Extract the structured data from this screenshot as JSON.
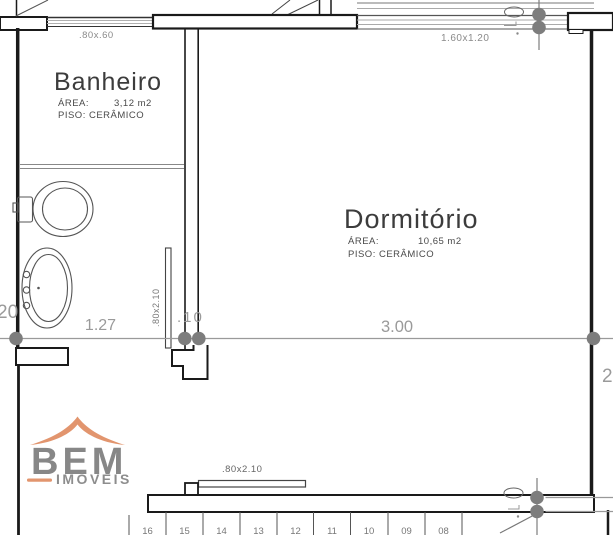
{
  "drawing": {
    "rooms": {
      "banheiro": {
        "name": "Banheiro",
        "area_label": "ÁREA:",
        "area_value": "3,12 m2",
        "floor_line": "PISO: CERÂMICO"
      },
      "dormitorio": {
        "name": "Dormitório",
        "area_label": "ÁREA:",
        "area_value": "10,65 m2",
        "floor_line": "PISO: CERÂMICO"
      }
    },
    "windows": {
      "banheiro_window": ".80x.60",
      "dormitorio_window": "1.60x1.20"
    },
    "doors": {
      "banheiro_door": ".80x2.10",
      "hall_door": ".80x2.10"
    },
    "dimensions": {
      "left_partial": "20",
      "banheiro_width": "1.27",
      "wall_thickness": ".10",
      "dormitorio_width": "3.00",
      "right_partial": "2"
    },
    "stairs": {
      "steps": [
        "16",
        "15",
        "14",
        "13",
        "12",
        "11",
        "10",
        "09",
        "08"
      ]
    },
    "logo": {
      "line1": "BEM",
      "line2": "IMÓVEIS",
      "accent_color": "#e2956e",
      "text_color": "#878787"
    },
    "colors": {
      "wall": "#1a1a1a",
      "thin_line": "#8f8f8f",
      "dimension_line": "#9a9a9a",
      "marker": "#7d7d7d"
    }
  }
}
